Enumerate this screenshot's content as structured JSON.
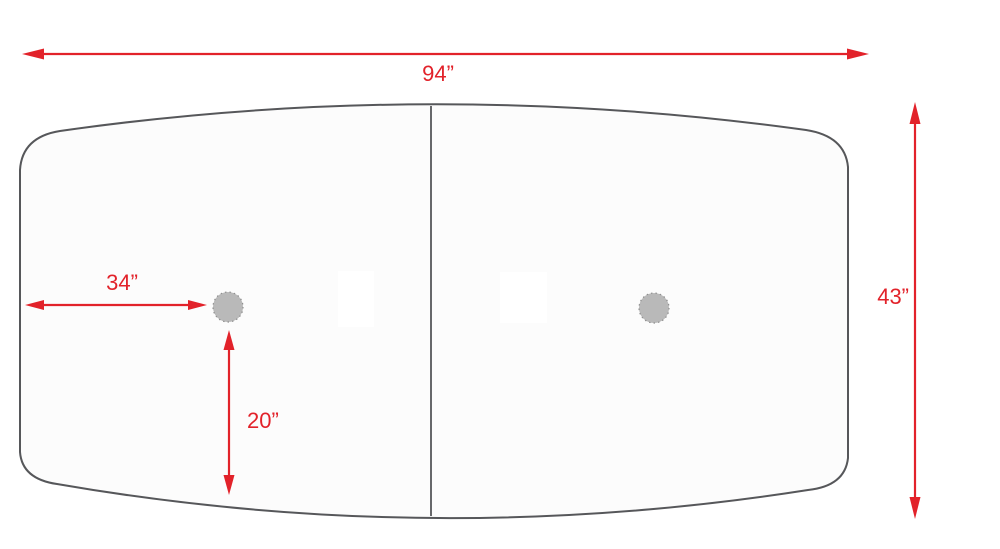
{
  "colors": {
    "dimension_red": "#e2222a",
    "tabletop_outline": "#56575a",
    "center_seam": "#67686b",
    "grommet_fill": "#b9b9b9",
    "grommet_edge": "#8f8f8f",
    "tabletop_fill": "#fcfcfc",
    "background": "#ffffff"
  },
  "dimensions": {
    "overall_width": "94”",
    "overall_depth": "43”",
    "grommet_offset_from_left": "34”",
    "grommet_offset_from_bottom": "20”"
  }
}
